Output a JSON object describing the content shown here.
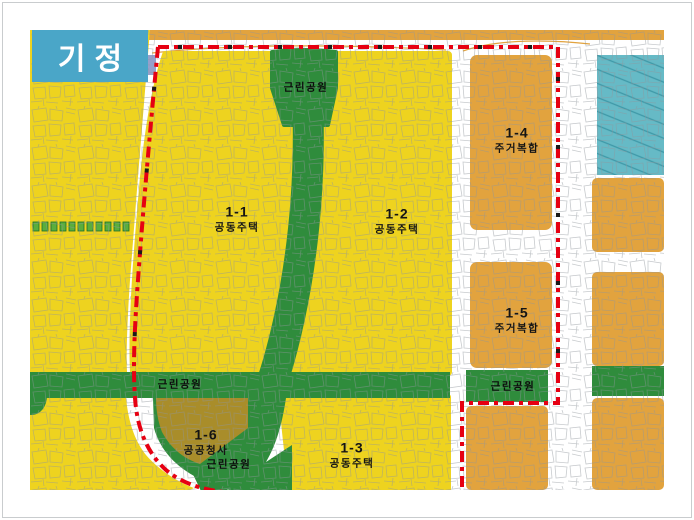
{
  "badge": {
    "label": "기정"
  },
  "map": {
    "zones": [
      {
        "code": "1-1",
        "use": "공동주택"
      },
      {
        "code": "1-2",
        "use": "공동주택"
      },
      {
        "code": "1-3",
        "use": "공동주택"
      },
      {
        "code": "1-4",
        "use": "주거복합"
      },
      {
        "code": "1-5",
        "use": "주거복합"
      },
      {
        "code": "1-6",
        "use": "공공청사"
      }
    ],
    "parks": {
      "top": "근린공원",
      "west_band": "근린공원",
      "south": "근린공원",
      "east_band": "근린공원"
    },
    "colors": {
      "residential_yellow": "#eed31f",
      "mixed_use_orange": "#e2a33e",
      "park_green": "#2f8c3c",
      "public_office_olive": "#a98d2a",
      "hatched_teal": "#66bac6",
      "boundary_red": "#e60012",
      "badge_blue": "#4aa6c8",
      "road_white": "#ffffff",
      "street_line_gray": "#8f959b"
    }
  }
}
